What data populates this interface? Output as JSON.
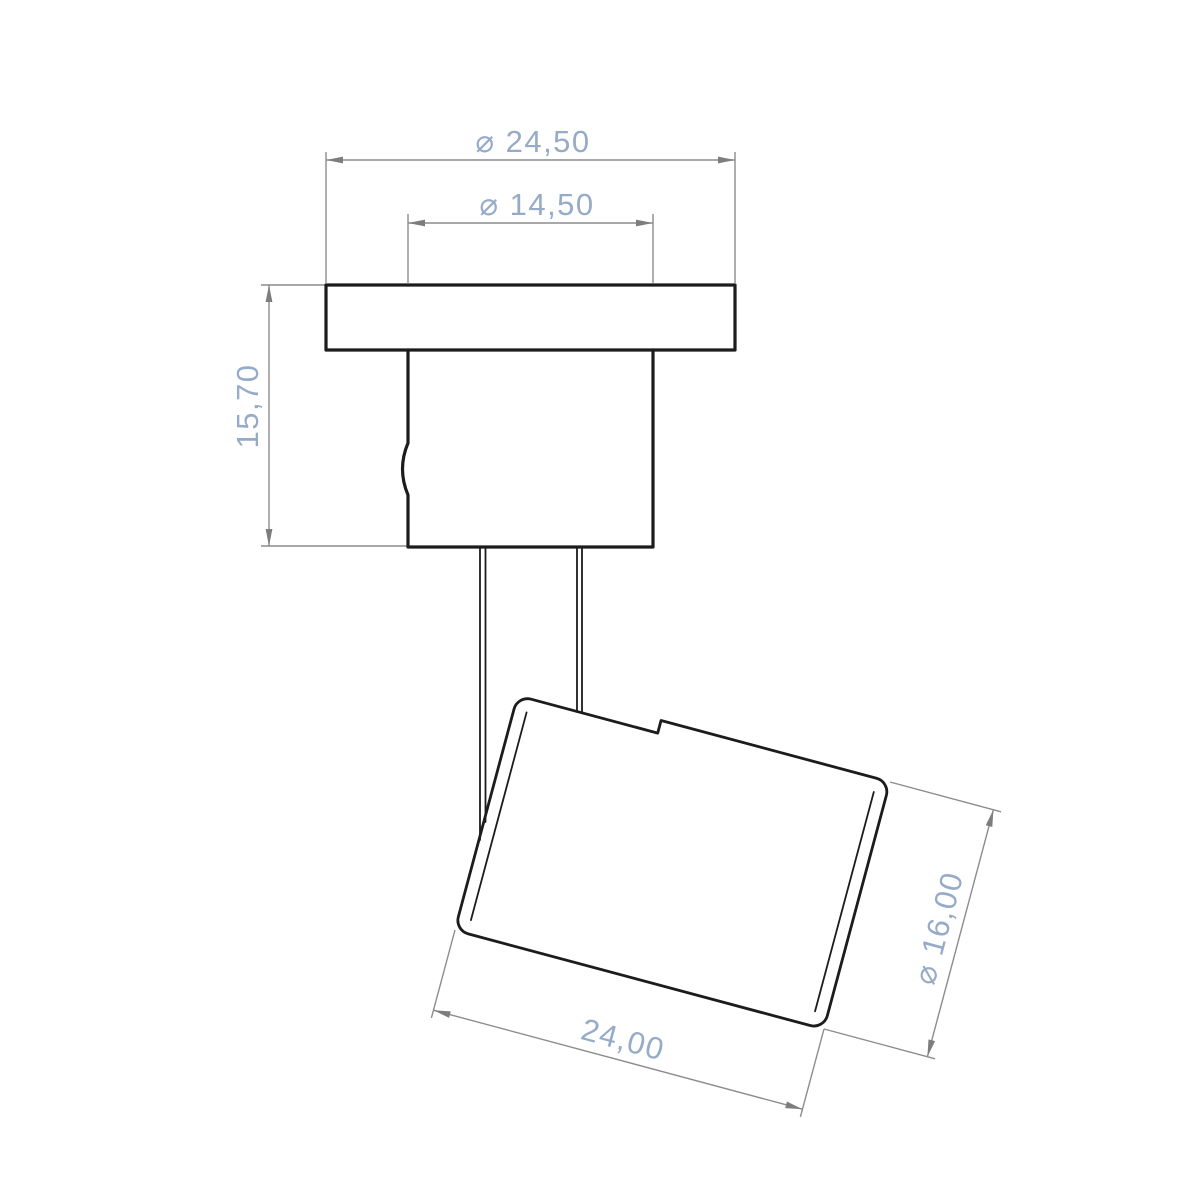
{
  "canvas": {
    "width": 1200,
    "height": 1200,
    "background": "#ffffff"
  },
  "drawing": {
    "style": {
      "outline_color": "#1c1c1c",
      "dimension_line_color": "#8c8c8c",
      "dimension_text_color": "#96abc8"
    },
    "dimensions": [
      {
        "id": "flange-diameter",
        "type": "diameter",
        "value": "24,50",
        "label": "⌀ 24,50"
      },
      {
        "id": "boss-diameter",
        "type": "diameter",
        "value": "14,50",
        "label": "⌀ 14,50"
      },
      {
        "id": "boss-height",
        "type": "linear",
        "value": "15,70",
        "label": "15,70"
      },
      {
        "id": "barrel-length",
        "type": "linear",
        "value": "24,00",
        "label": "24,00"
      },
      {
        "id": "barrel-diameter",
        "type": "diameter",
        "value": "16,00",
        "label": "⌀ 16,00"
      }
    ]
  }
}
